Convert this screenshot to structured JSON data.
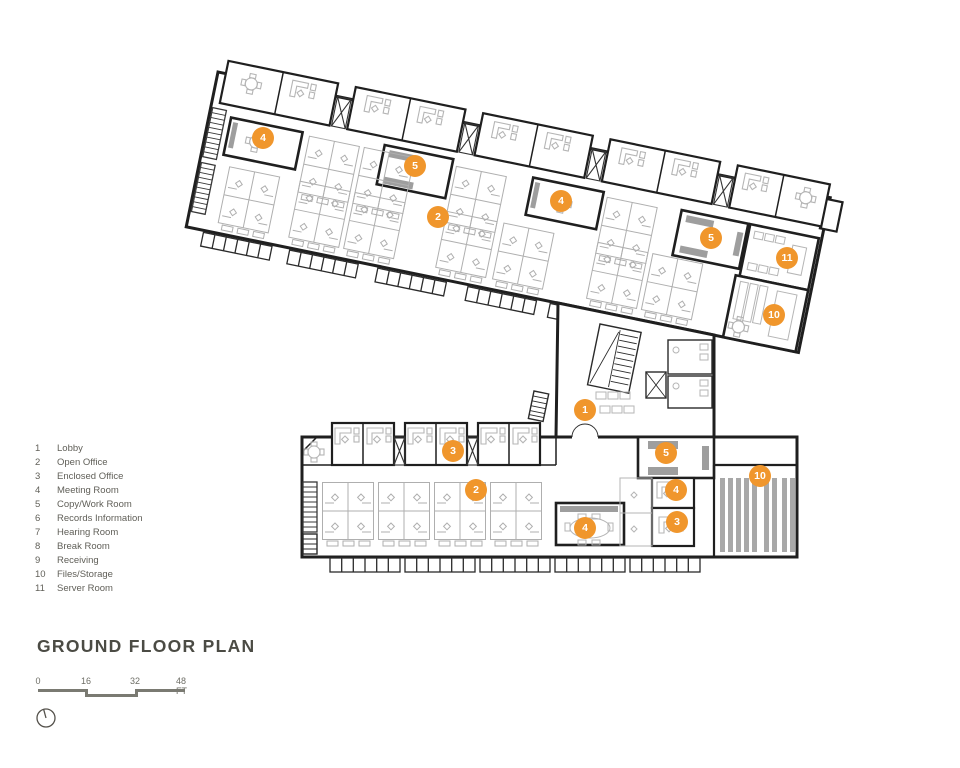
{
  "title": "GROUND FLOOR PLAN",
  "legend": {
    "items": [
      {
        "num": "1",
        "label": "Lobby"
      },
      {
        "num": "2",
        "label": "Open Office"
      },
      {
        "num": "3",
        "label": "Enclosed Office"
      },
      {
        "num": "4",
        "label": "Meeting Room"
      },
      {
        "num": "5",
        "label": "Copy/Work Room"
      },
      {
        "num": "6",
        "label": "Records Information"
      },
      {
        "num": "7",
        "label": "Hearing Room"
      },
      {
        "num": "8",
        "label": "Break Room"
      },
      {
        "num": "9",
        "label": "Receiving"
      },
      {
        "num": "10",
        "label": "Files/Storage"
      },
      {
        "num": "11",
        "label": "Server Room"
      }
    ]
  },
  "scale_bar": {
    "labels": [
      "0",
      "16",
      "32",
      "48 FT"
    ]
  },
  "markers": [
    {
      "num": "4",
      "x": 263,
      "y": 138
    },
    {
      "num": "5",
      "x": 415,
      "y": 166
    },
    {
      "num": "2",
      "x": 438,
      "y": 217
    },
    {
      "num": "4",
      "x": 561,
      "y": 201
    },
    {
      "num": "5",
      "x": 711,
      "y": 238
    },
    {
      "num": "11",
      "x": 787,
      "y": 258
    },
    {
      "num": "10",
      "x": 774,
      "y": 315
    },
    {
      "num": "1",
      "x": 585,
      "y": 410
    },
    {
      "num": "3",
      "x": 453,
      "y": 451
    },
    {
      "num": "5",
      "x": 666,
      "y": 453
    },
    {
      "num": "2",
      "x": 476,
      "y": 490
    },
    {
      "num": "4",
      "x": 676,
      "y": 490
    },
    {
      "num": "10",
      "x": 760,
      "y": 476
    },
    {
      "num": "4",
      "x": 585,
      "y": 528
    },
    {
      "num": "3",
      "x": 677,
      "y": 522
    }
  ],
  "colors": {
    "accent_orange": "#F0962C",
    "wall_dark": "#1F1F1F",
    "furniture_gray": "#B5B5B5",
    "equipment_gray": "#9E9E9E",
    "text_gray": "#605F58",
    "title_gray": "#4B4B44"
  }
}
